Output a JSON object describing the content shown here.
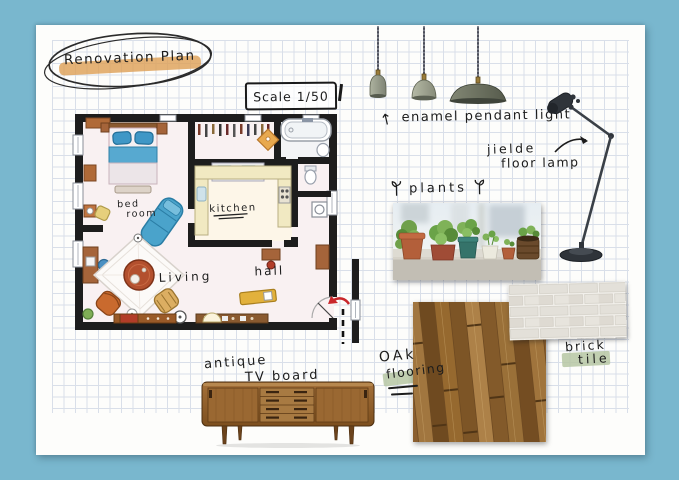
{
  "board": {
    "title": "Renovation Plan",
    "scale_label": "Scale 1/50"
  },
  "floor_plan": {
    "bedroom_line1": "bed",
    "bedroom_line2": "room",
    "kitchen": "kitchen",
    "living": "Living",
    "hall": "hall"
  },
  "annotations": {
    "pendant_arrow": "↑",
    "pendant_label": "enamel pendant light",
    "floorlamp_line1": "jielde",
    "floorlamp_line2": "floor lamp",
    "plants_label": "plants",
    "oak_line1": "OAk",
    "oak_line2": "flooring",
    "brick_line1": "brick",
    "brick_line2": "tile",
    "tv_line1": "antique",
    "tv_line2": "TV board"
  },
  "colors": {
    "background": "#79b7ce",
    "paper": "#fdfdfb",
    "grid_line": "#d9dfe9",
    "ink": "#1c1c1c",
    "marker_orange": "#dda156",
    "marker_green": "#b6c7a3",
    "wall_black": "#1d1d1d",
    "bed_blue": "#4aa3cb",
    "wood_orange": "#b9622f",
    "teak_brown": "#96682f",
    "arrow_red": "#c9272b"
  }
}
